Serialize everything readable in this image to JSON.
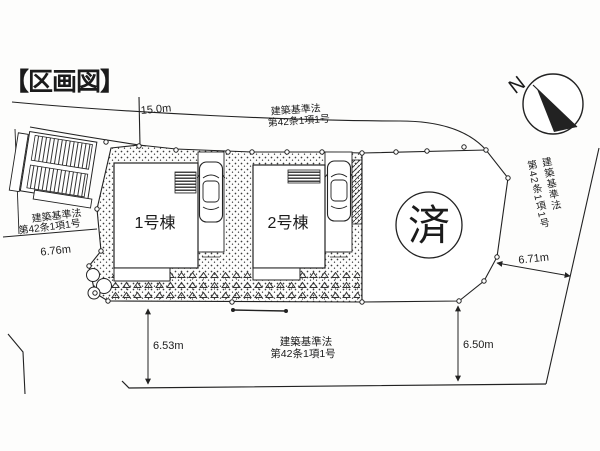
{
  "page": {
    "background": "#fdfdfc",
    "ink": "#222222"
  },
  "title": "【区画図】",
  "plan": {
    "lots": [
      {
        "label": "1号棟"
      },
      {
        "label": "2号棟"
      }
    ],
    "sold_label": "済",
    "compass_label": "N",
    "dimensions": {
      "road_top": "15.0m",
      "west": "6.76m",
      "east": "6.71m",
      "south_west": "6.53m",
      "south_east": "6.50m"
    },
    "law_labels": {
      "top": {
        "l1": "建築基準法",
        "l2": "第42条1項1号"
      },
      "west": {
        "l1": "建築基準法",
        "l2": "第42条1項1号"
      },
      "east": {
        "l1": "建築基準法",
        "l2": "第42条1項1号"
      },
      "south": {
        "l1": "建築基準法",
        "l2": "第42条1項1号"
      }
    }
  }
}
